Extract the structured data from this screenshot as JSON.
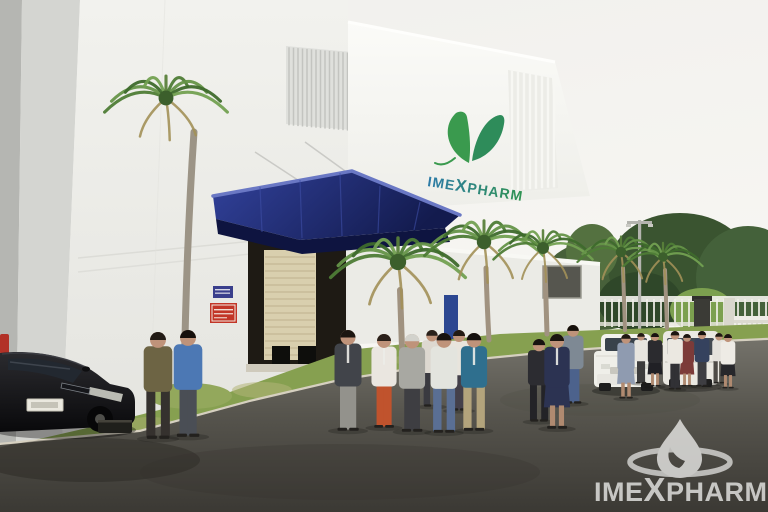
{
  "image": {
    "type": "photograph",
    "subject": "Group of visitors walking along the driveway outside the Imexpharm pharmaceutical factory",
    "setting": "white factory building with blue loading-dock canopy, palm trees, lawn, asphalt road, perimeter fence and entrance gate"
  },
  "building_logo": {
    "text": "IMEXPHARM",
    "part1": "IME",
    "part2": "X",
    "part3": "PHARM",
    "icon": "butterfly-leaf-icon",
    "color_left": "#2d7ba8",
    "color_right": "#2f9350"
  },
  "watermark": {
    "text": "IMEXPHARM",
    "part1": "IME",
    "part2": "X",
    "part3": "PHARM",
    "icon": "droplet-ellipse-icon",
    "color": "#e9e9e7"
  },
  "signs": {
    "blue_sign_color": "#3a3f8c",
    "red_sign_color": "#c23527"
  },
  "colors": {
    "sky": "#f4f3f0",
    "canopy_blue": "#1f2a6e",
    "road": "#524f49",
    "grass": "#86a050",
    "logo_green": "#2f9350"
  },
  "scene": {
    "palms": [
      {
        "cx": 166,
        "cy": 98,
        "r": 62,
        "tw": 7,
        "trunkColor": "#9c9486",
        "trunk": [
          [
            194,
            132
          ],
          [
            186,
            250
          ],
          [
            184,
            392
          ]
        ]
      },
      {
        "cx": 398,
        "cy": 262,
        "r": 68,
        "tw": 6,
        "trunk": [
          [
            400,
            290
          ],
          [
            401,
            320
          ],
          [
            402,
            348
          ]
        ]
      },
      {
        "cx": 484,
        "cy": 242,
        "r": 60,
        "tw": 5,
        "trunk": [
          [
            486,
            268
          ],
          [
            487,
            305
          ],
          [
            489,
            340
          ]
        ]
      },
      {
        "cx": 543,
        "cy": 248,
        "r": 50,
        "tw": 5,
        "trunk": [
          [
            545,
            268
          ],
          [
            546,
            300
          ],
          [
            547,
            334
          ]
        ]
      },
      {
        "cx": 621,
        "cy": 252,
        "r": 44,
        "tw": 4,
        "trunk": [
          [
            623,
            268
          ],
          [
            624,
            300
          ],
          [
            625,
            330
          ]
        ]
      },
      {
        "cx": 663,
        "cy": 257,
        "r": 40,
        "tw": 4,
        "trunk": [
          [
            665,
            270
          ],
          [
            666,
            300
          ],
          [
            667,
            328
          ]
        ]
      }
    ],
    "people": [
      {
        "x": 158,
        "y": 438,
        "h": 106,
        "shirt": "#6d6444",
        "pants": "#35312e",
        "hair": "#221b16"
      },
      {
        "x": 188,
        "y": 436,
        "h": 106,
        "shirt": "#4c78b4",
        "pants": "#4a4e55",
        "hair": "#16100c"
      },
      {
        "x": 348,
        "y": 430,
        "h": 100,
        "shirt": "#41444a",
        "pants": "#93928c",
        "hair": "#1c1611",
        "lanyard": true
      },
      {
        "x": 384,
        "y": 427,
        "h": 93,
        "shirt": "#eae6e0",
        "pants": "#c0532d",
        "hair": "#2a201a",
        "lanyard": true
      },
      {
        "x": 412,
        "y": 431,
        "h": 97,
        "shirt": "#a8a8a2",
        "pants": "#3e3e42",
        "hair": "#d2d2cc"
      },
      {
        "x": 444,
        "y": 432,
        "h": 99,
        "shirt": "#e3e4de",
        "pants": "#5a6f94",
        "hair": "#171210"
      },
      {
        "x": 459,
        "y": 410,
        "h": 80,
        "shirt": "#e8e4dc",
        "pants": "#44404a",
        "hair": "#231a14"
      },
      {
        "x": 474,
        "y": 430,
        "h": 97,
        "shirt": "#2f6f8e",
        "pants": "#b3a47c",
        "hair": "#14100d",
        "lanyard": true
      },
      {
        "x": 432,
        "y": 406,
        "h": 76,
        "shirt": "#ddd8d0",
        "pants": "#3a3a40",
        "hair": "#2a211b"
      },
      {
        "x": 539,
        "y": 421,
        "h": 82,
        "shirt": "#2c2c31",
        "pants": "#232327",
        "hair": "#171310"
      },
      {
        "x": 557,
        "y": 428,
        "h": 94,
        "shirt": "#2c3352",
        "pants": "#2c3352",
        "hair": "#1b150f",
        "skirt": true,
        "lanyard": true
      },
      {
        "x": 573,
        "y": 403,
        "h": 78,
        "shirt": "#7e8994",
        "pants": "#4c628c",
        "hair": "#15100b"
      },
      {
        "x": 626,
        "y": 398,
        "h": 64,
        "shirt": "#8f9bb0",
        "pants": "#8f9bb0",
        "hair": "#1f1812",
        "skirt": true
      },
      {
        "x": 641,
        "y": 383,
        "h": 50,
        "shirt": "#e7e5df",
        "pants": "#3c3c3c",
        "hair": "#221a14"
      },
      {
        "x": 655,
        "y": 386,
        "h": 53,
        "shirt": "#2b2b2f",
        "pants": "#202025",
        "hair": "#171310",
        "skirt": true
      },
      {
        "x": 675,
        "y": 389,
        "h": 58,
        "shirt": "#ebe8e1",
        "pants": "#313135",
        "hair": "#1c1510"
      },
      {
        "x": 687,
        "y": 386,
        "h": 52,
        "shirt": "#7c3b39",
        "pants": "#7c3b39",
        "hair": "#1d1712",
        "skirt": true
      },
      {
        "x": 702,
        "y": 386,
        "h": 55,
        "shirt": "#35425e",
        "pants": "#3e3e42",
        "hair": "#16110d"
      },
      {
        "x": 719,
        "y": 383,
        "h": 50,
        "shirt": "#e4e2dc",
        "pants": "#4e4b46",
        "hair": "#201a14"
      },
      {
        "x": 728,
        "y": 388,
        "h": 54,
        "shirt": "#eeebe5",
        "pants": "#27272b",
        "hair": "#1b1510",
        "skirt": true
      }
    ],
    "vehicles": [
      {
        "type": "black-sedan",
        "position": "bottom-left"
      },
      {
        "type": "white-sedan",
        "position": "center-right"
      },
      {
        "type": "white-van",
        "position": "right"
      }
    ]
  }
}
